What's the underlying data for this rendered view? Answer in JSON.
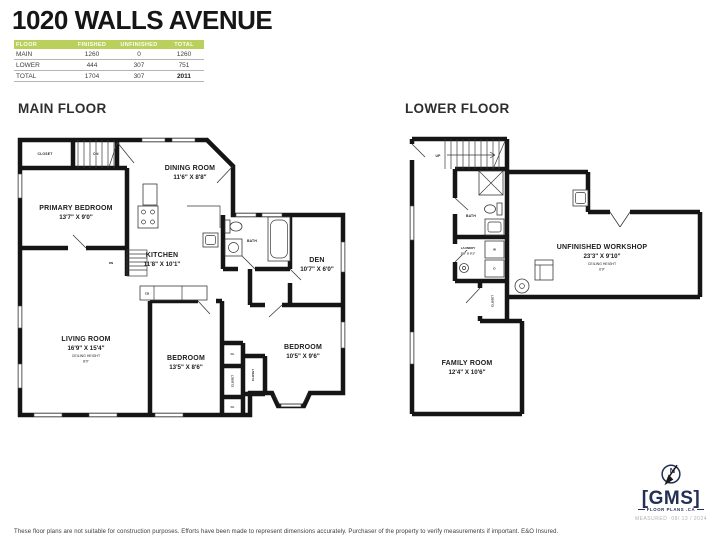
{
  "colors": {
    "table_header_green": "#b9d05c",
    "logo_navy": "#232f55",
    "wall_black": "#151515"
  },
  "header": {
    "title": "1020 WALLS AVENUE",
    "area_table": {
      "columns": [
        "FLOOR",
        "FINISHED",
        "UNFINISHED",
        "TOTAL"
      ],
      "rows": [
        {
          "floor": "MAIN",
          "finished": "1260",
          "unfinished": "0",
          "total": "1260"
        },
        {
          "floor": "LOWER",
          "finished": "444",
          "unfinished": "307",
          "total": "751"
        },
        {
          "floor": "TOTAL",
          "finished": "1704",
          "unfinished": "307",
          "total": "2011"
        }
      ]
    }
  },
  "main_floor": {
    "heading": "MAIN FLOOR",
    "labels": {
      "closet": "CLOSET",
      "stairs_dn": "DN",
      "dining_name": "DINING ROOM",
      "dining_dims": "11'6\" X 8'8\"",
      "primary_name": "PRIMARY BEDROOM",
      "primary_dims": "13'7\" X 9'0\"",
      "kitchen_name": "KITCHEN",
      "kitchen_dims": "11'8\" X 10'1\"",
      "bath": "BATH",
      "den_name": "DEN",
      "den_dims": "10'7\" X 6'0\"",
      "stairs_dn2": "DN",
      "cb": "CB",
      "living_name": "LIVING ROOM",
      "living_dims": "16'9\" X 15'4\"",
      "living_ceiling_label": "CEILING HEIGHT",
      "living_ceiling_value": "8'0\"",
      "bedroom1_name": "BEDROOM",
      "bedroom1_dims": "13'5\" X 8'6\"",
      "bedroom2_name": "BEDROOM",
      "bedroom2_dims": "10'5\" X 9'6\"",
      "cl_top": "CL",
      "closet_left": "CLOSET",
      "closet_right": "CLOSET",
      "cl_bottom": "CL"
    }
  },
  "lower_floor": {
    "heading": "LOWER FLOOR",
    "labels": {
      "stairs_up": "UP",
      "bath": "BATH",
      "laundry_name": "LAUNDRY",
      "laundry_dims": "5'8\" X 5'1\"",
      "washer": "W",
      "dryer": "D",
      "closet": "CLOSET",
      "workshop_name": "UNFINISHED WORKSHOP",
      "workshop_dims": "23'3\" X 9'10\"",
      "workshop_ceiling_label": "CEILING HEIGHT",
      "workshop_ceiling_value": "6'9\"",
      "family_name": "FAMILY ROOM",
      "family_dims": "12'4\" X 10'6\""
    }
  },
  "footer": {
    "disclaimer": "These floor plans are not suitable for construction purposes. Efforts have been made to represent dimensions accurately.  Purchaser of the property to verify measurements if important.  E&O Insured.",
    "logo": {
      "bracket_left": "[",
      "name": "GMS",
      "bracket_right": "]",
      "tagline": "FLOOR PLANS .CA",
      "compass_letter": "N",
      "measured_label": "MEASURED",
      "measured_date": "08/ 13 / 2024"
    }
  }
}
